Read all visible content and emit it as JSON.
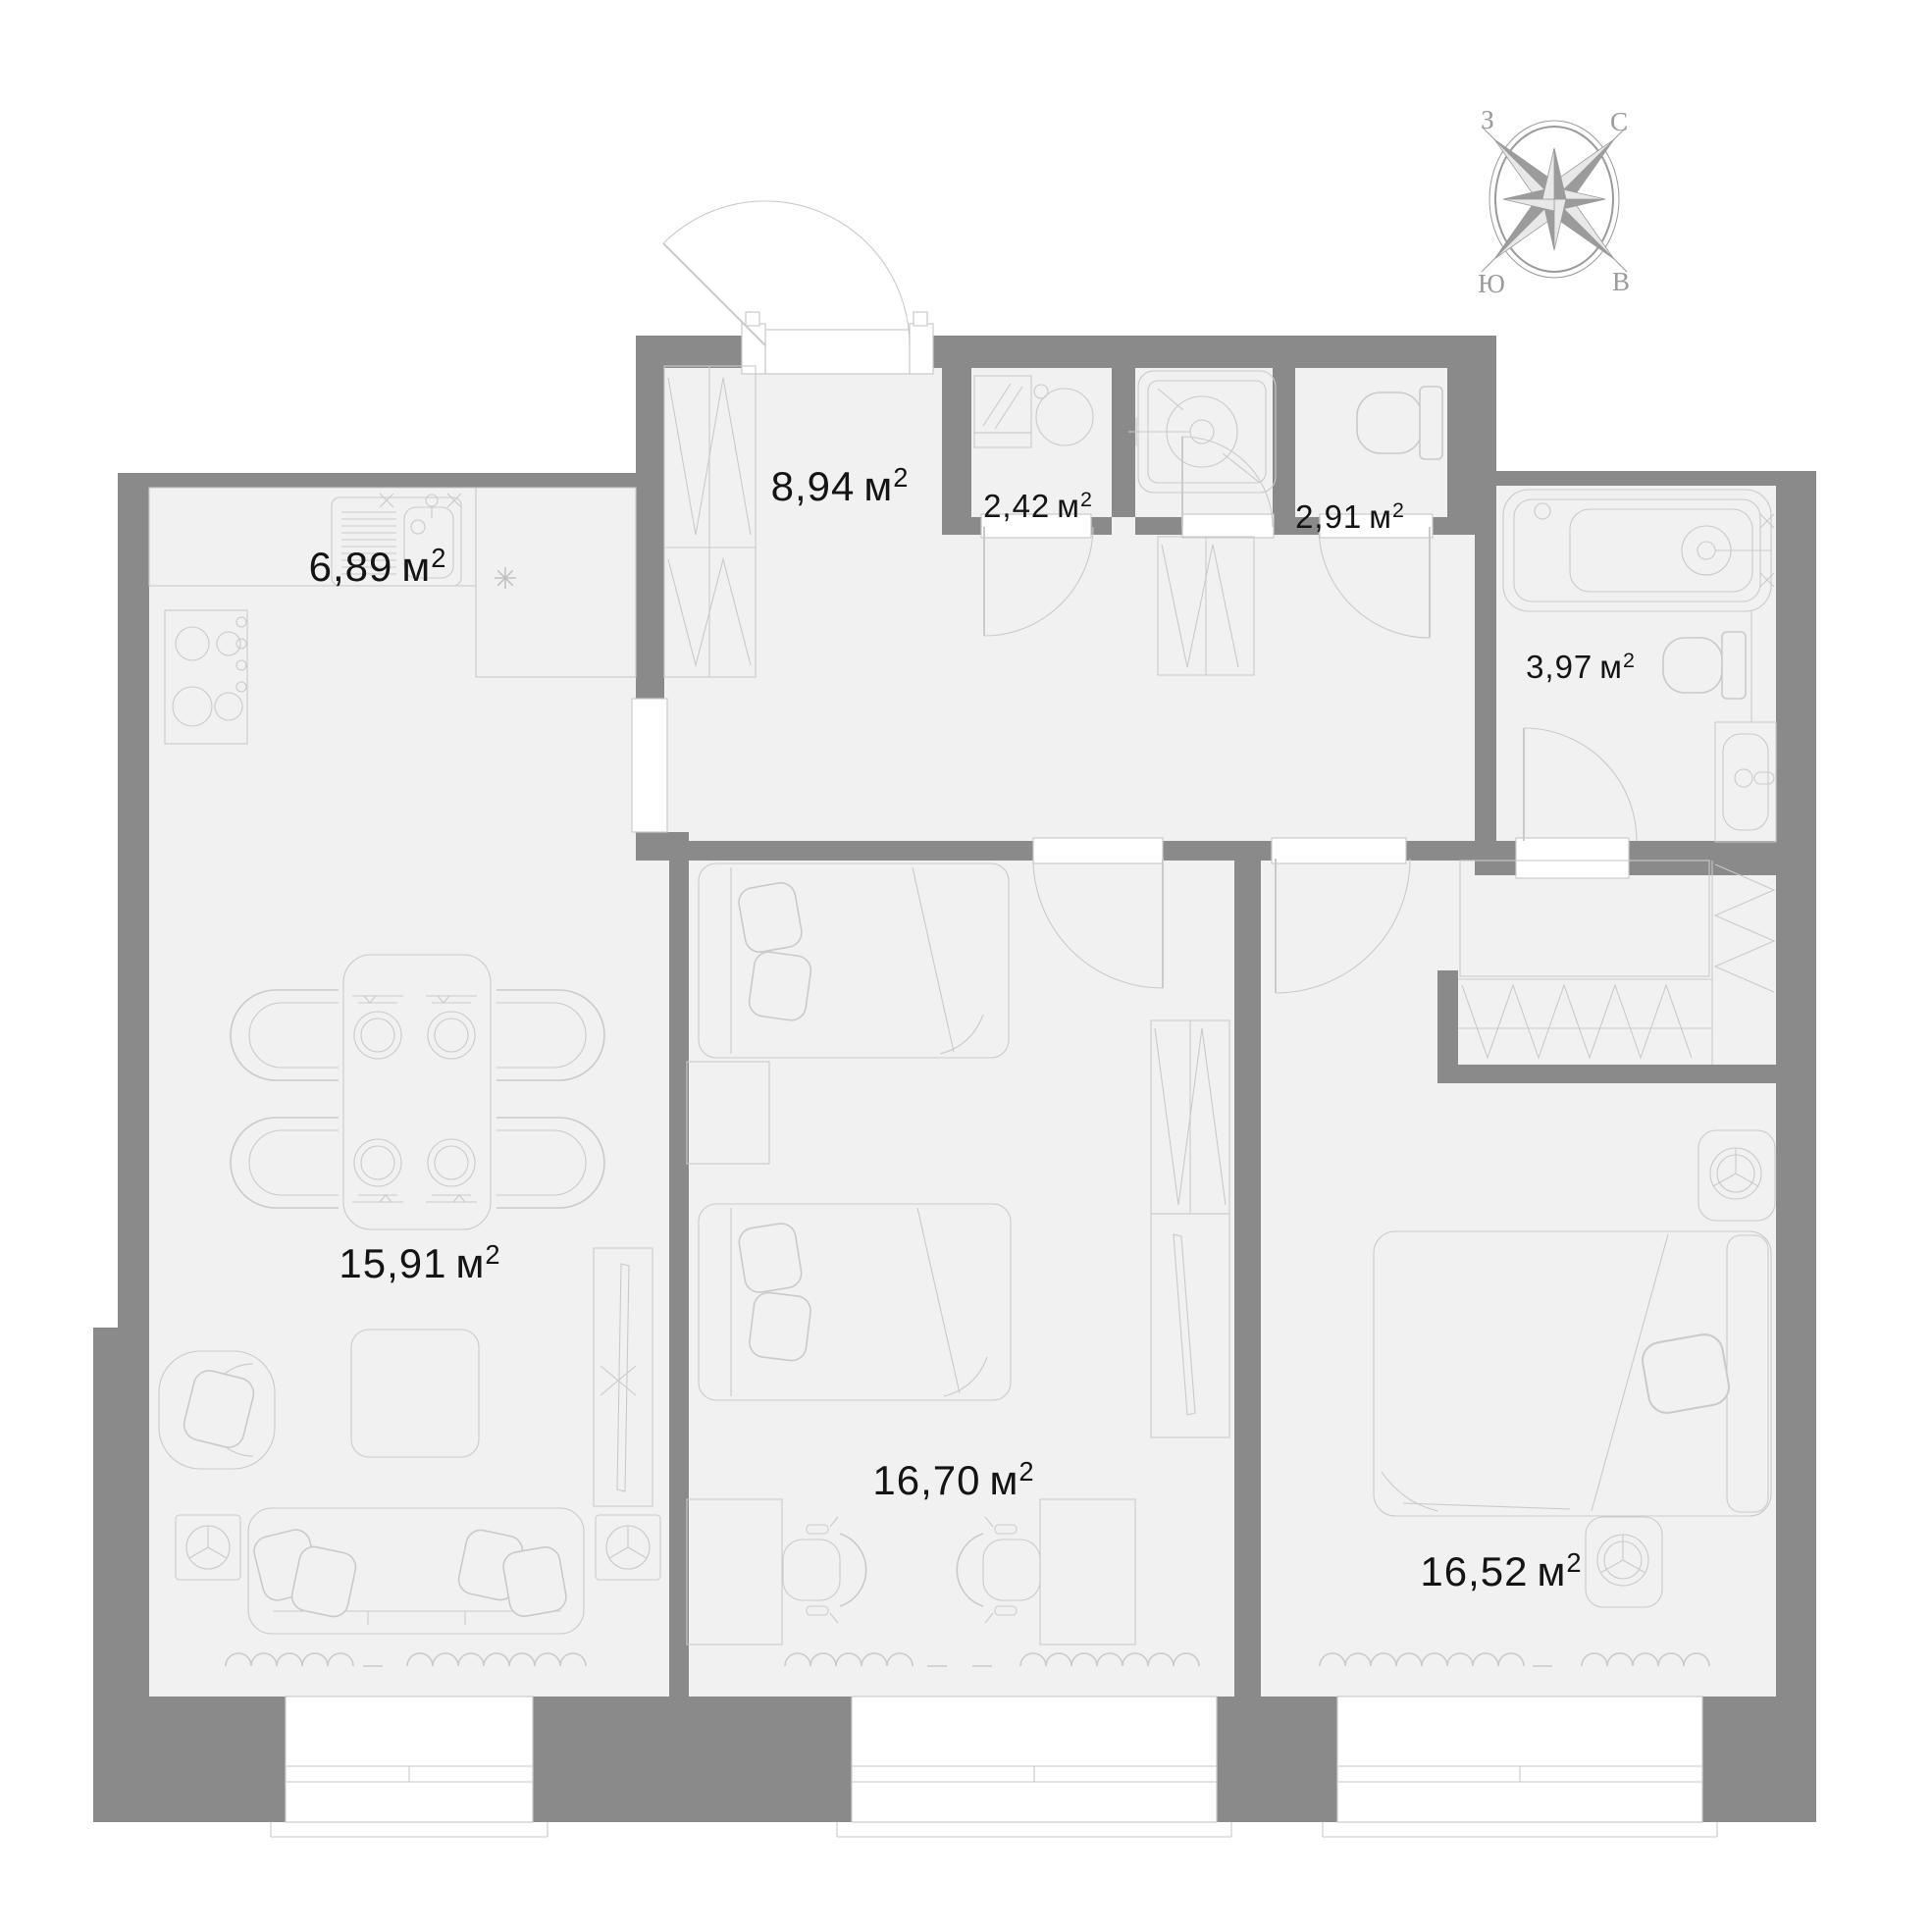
{
  "plan": {
    "type": "apartment-floor-plan",
    "rooms": [
      {
        "name": "kitchen",
        "area": "6,89"
      },
      {
        "name": "hallway",
        "area": "8,94"
      },
      {
        "name": "laundry",
        "area": "2,42"
      },
      {
        "name": "shower-room",
        "area": "2,91"
      },
      {
        "name": "bathroom",
        "area": "3,97"
      },
      {
        "name": "living-room",
        "area": "15,91"
      },
      {
        "name": "bedroom-1",
        "area": "16,70"
      },
      {
        "name": "bedroom-2",
        "area": "16,52"
      }
    ],
    "unit": {
      "symbol": "м",
      "sup": "2"
    }
  },
  "compass": {
    "north": "С",
    "east": "В",
    "south": "Ю",
    "west": "З"
  },
  "symbols": {
    "fridge": "✳"
  },
  "colors": {
    "wall": "#8a8a8a",
    "floor": "#f1f1f2",
    "line": "#c9cacc",
    "text": "#141414",
    "compass": "#9b9b9b"
  }
}
